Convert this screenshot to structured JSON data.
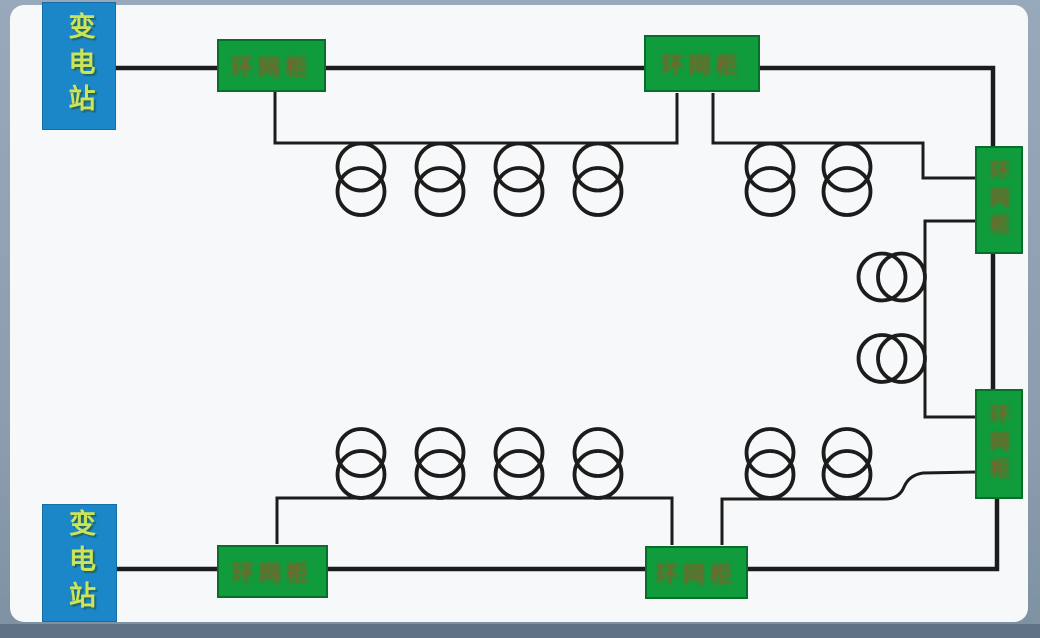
{
  "diagram": {
    "type": "ring-main-unit-power-distribution",
    "substations": [
      {
        "id": "substation-top-left",
        "label": "变电站"
      },
      {
        "id": "substation-bottom-left",
        "label": "变电站"
      }
    ],
    "rmu_boxes": [
      {
        "id": "rmu-top-left",
        "label": "环网柜"
      },
      {
        "id": "rmu-top-middle",
        "label": "环网柜"
      },
      {
        "id": "rmu-right-upper",
        "label": "环网柜"
      },
      {
        "id": "rmu-right-lower",
        "label": "环网柜"
      },
      {
        "id": "rmu-bottom-left",
        "label": "环网柜"
      },
      {
        "id": "rmu-bottom-middle",
        "label": "环网柜"
      }
    ],
    "transformer_symbol": "two-overlapping-circles",
    "transformer_groups": [
      {
        "position": "top-left-bus",
        "count": 4,
        "orientation": "vertical-pair"
      },
      {
        "position": "top-right-bus",
        "count": 2,
        "orientation": "vertical-pair"
      },
      {
        "position": "middle-right-branch",
        "count": 2,
        "orientation": "horizontal-pair"
      },
      {
        "position": "bottom-left-bus",
        "count": 4,
        "orientation": "vertical-pair"
      },
      {
        "position": "bottom-right-bus",
        "count": 2,
        "orientation": "vertical-pair"
      }
    ],
    "colors": {
      "substation_fill": "#1b86c8",
      "substation_text": "#cde45a",
      "rmu_fill": "#15993f",
      "rmu_border": "#0c6e2d",
      "rmu_text": "#9a5227",
      "line": "#1c1c1c",
      "frame": "#8a9cae",
      "frame_bottom": "#5f7286",
      "canvas": "#f7f8f9"
    }
  }
}
